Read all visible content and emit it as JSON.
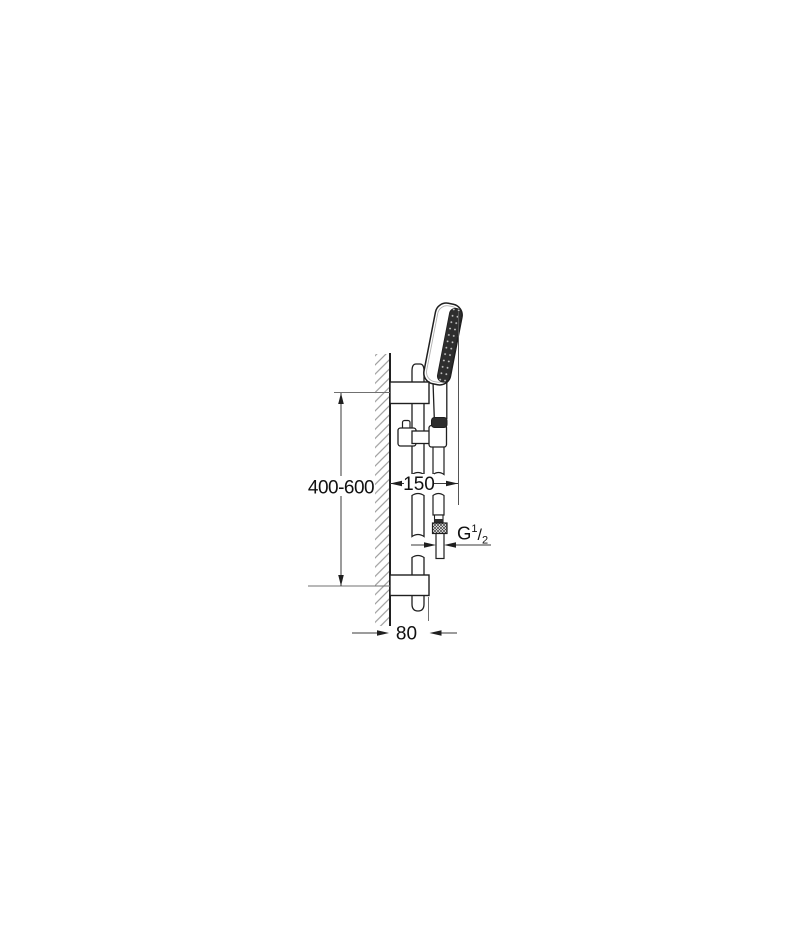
{
  "page": {
    "background": "#ffffff"
  },
  "drawing": {
    "type": "technical-dimension-diagram",
    "subject": "wall-mounted shower rail set, side view",
    "colors": {
      "outline": "#1f1f1f",
      "hatch": "#8c8c8c",
      "extension_line": "#707070",
      "dimension_line": "#3a3a3a",
      "dark_fill": "#2e2e2e",
      "spray_dot": "#d9d9d9"
    },
    "dimensions": {
      "rail_height_range": {
        "label": "400-600"
      },
      "wall_to_hose": {
        "label": "150"
      },
      "wall_to_rail_end": {
        "label": "80"
      },
      "thread": {
        "prefix": "G",
        "numerator": "1",
        "slash": "/",
        "denominator": "2"
      }
    }
  }
}
